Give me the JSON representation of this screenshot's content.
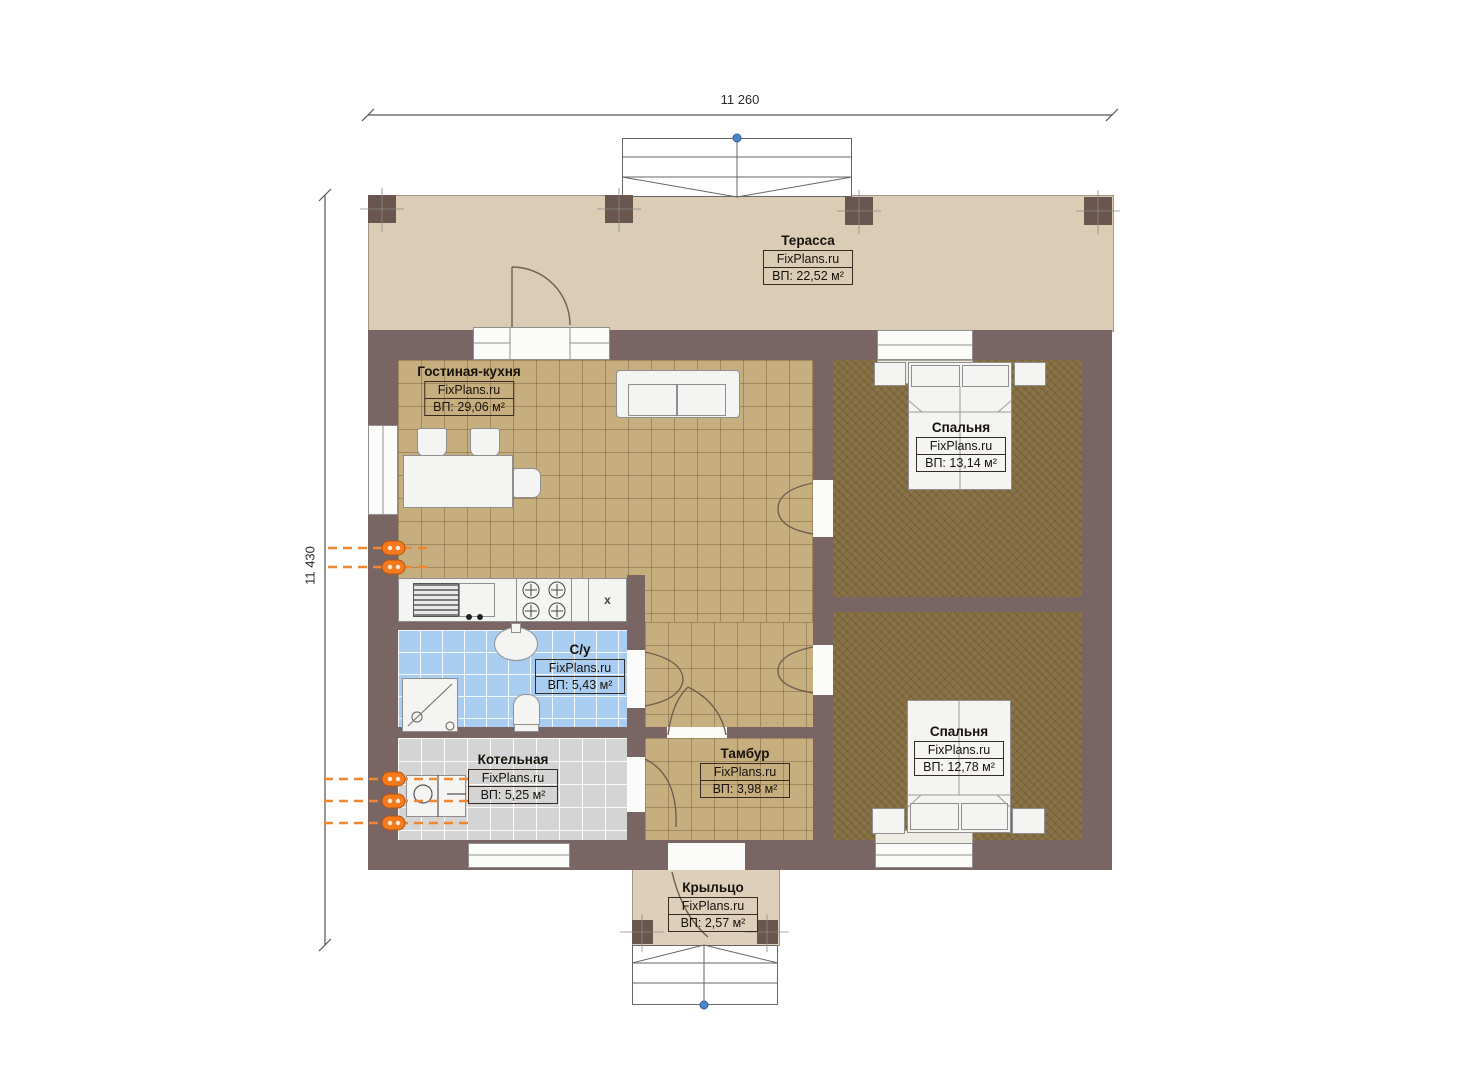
{
  "dimensions": {
    "width_top": "11 260",
    "height_left": "11 430"
  },
  "rooms": {
    "terrace": {
      "name": "Терасса",
      "brand": "FixPlans.ru",
      "area": "ВП: 22,52 м²"
    },
    "living_kitchen": {
      "name": "Гостиная-кухня",
      "brand": "FixPlans.ru",
      "area": "ВП: 29,06 м²"
    },
    "bedroom_top": {
      "name": "Спальня",
      "brand": "FixPlans.ru",
      "area": "ВП: 13,14 м²"
    },
    "bathroom": {
      "name": "С/у",
      "brand": "FixPlans.ru",
      "area": "ВП: 5,43 м²"
    },
    "boiler": {
      "name": "Котельная",
      "brand": "FixPlans.ru",
      "area": "ВП: 5,25 м²"
    },
    "vestibule": {
      "name": "Тамбур",
      "brand": "FixPlans.ru",
      "area": "ВП: 3,98 м²"
    },
    "bedroom_bottom": {
      "name": "Спальня",
      "brand": "FixPlans.ru",
      "area": "ВП: 12,78 м²"
    },
    "porch": {
      "name": "Крыльцо",
      "brand": "FixPlans.ru",
      "area": "ВП: 2,57 м²"
    }
  },
  "kitchen": {
    "appliance_label": "x"
  },
  "colors": {
    "wall": "#7a6565",
    "terrace_floor": "#dbccb6",
    "living_floor": "#c7ae7f",
    "bedroom_floor": "#8a7347",
    "bathroom_floor": "#a9cdf1",
    "boiler_floor": "#d4d4d4",
    "pipe_orange": "#f07a1e",
    "stair_marker_blue": "#4a86c8"
  }
}
